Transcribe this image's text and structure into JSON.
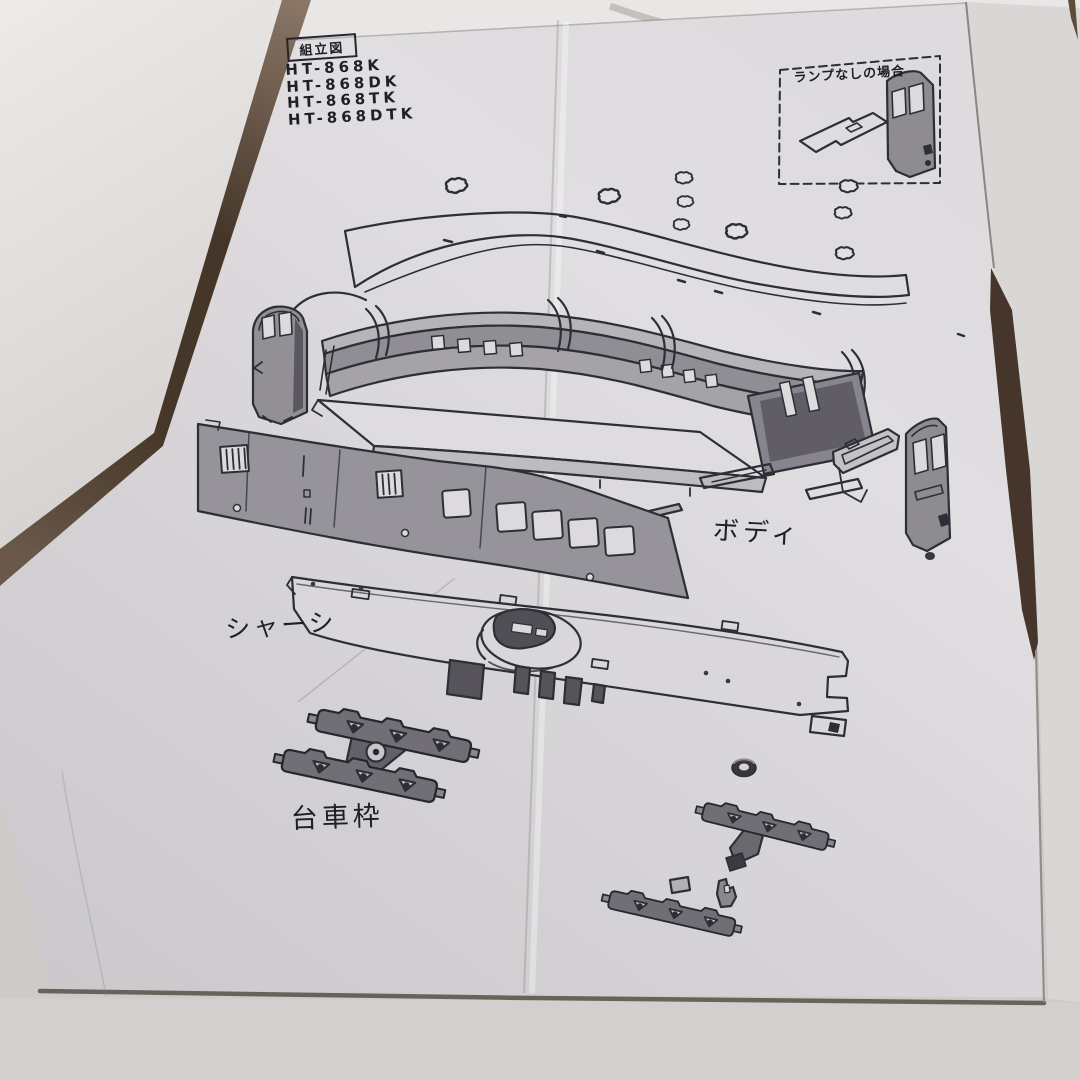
{
  "sheet": {
    "title": "組立図",
    "model_numbers": [
      "HT-868K",
      "HT-868DK",
      "HT-868TK",
      "HT-868DTK"
    ],
    "inset_caption": "ランプなしの場合",
    "labels": {
      "body": "ボディ",
      "chassis": "シャーシ",
      "truck_frame": "台車枠"
    }
  },
  "colors": {
    "paper": "#dcdadc",
    "ink": "#2b2b33",
    "background_gap": "#46352a",
    "part_fill": "#96939a"
  }
}
